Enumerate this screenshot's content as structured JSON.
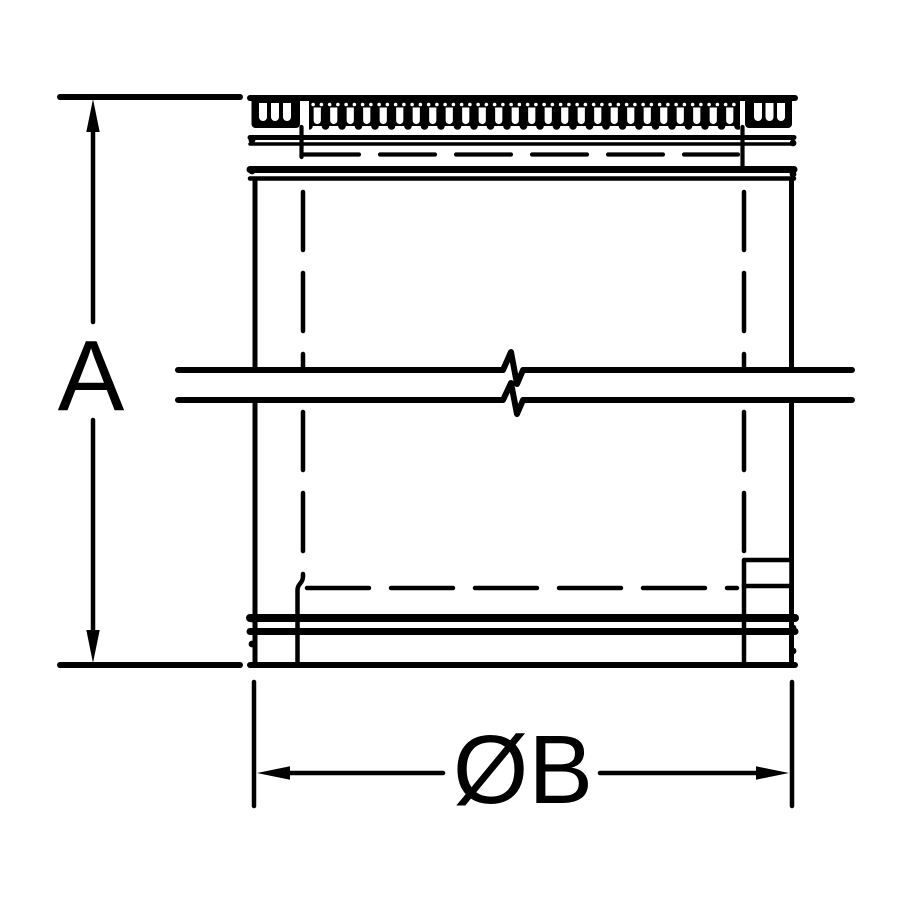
{
  "diagram": {
    "type": "dimension-drawing",
    "labels": {
      "height_dimension": "A",
      "diameter_dimension": "ØB"
    },
    "colors": {
      "line": "#000000",
      "background": "#ffffff"
    }
  }
}
